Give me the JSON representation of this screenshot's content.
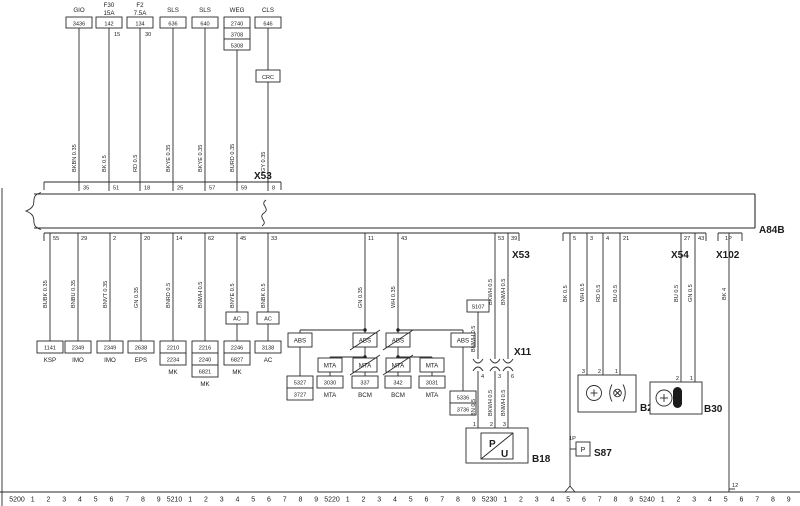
{
  "connectors": {
    "x53_top": "X53",
    "x53_bottom": "X53",
    "x54": "X54",
    "x102": "X102",
    "x11": "X11",
    "bus": "A84B"
  },
  "top_circuits": [
    {
      "name": "GIO",
      "boxes": [
        "3436"
      ],
      "wire": "BKBN 0.35",
      "pin": "35"
    },
    {
      "name": "F30",
      "rating": "15A",
      "boxes": [
        "142"
      ],
      "terminal": "15",
      "wire": "BK 0.5",
      "pin": "51"
    },
    {
      "name": "F2",
      "rating": "7.5A",
      "boxes": [
        "134"
      ],
      "terminal": "30",
      "wire": "RD 0.5",
      "pin": "18"
    },
    {
      "name": "SLS",
      "boxes": [
        "636"
      ],
      "wire": "BKYE 0.35",
      "pin": "25"
    },
    {
      "name": "SLS",
      "boxes": [
        "640"
      ],
      "wire": "BKYE 0.35",
      "pin": "57"
    },
    {
      "name": "WEG",
      "boxes": [
        "2740",
        "3708",
        "5308"
      ],
      "wire": "BURD 0.35",
      "pin": "59"
    },
    {
      "name": "CLS",
      "boxes": [
        "646"
      ],
      "inline_box": "CRC",
      "wire": "GY 0.35",
      "pin": "8"
    }
  ],
  "left_circuits": [
    {
      "pin": "55",
      "wire": "BUBK 0.35",
      "boxes": [
        "1141"
      ],
      "label": "KSP"
    },
    {
      "pin": "29",
      "wire": "BNBU 0.35",
      "boxes": [
        "2349"
      ],
      "label": "IMO"
    },
    {
      "pin": "2",
      "wire": "BNVT 0.35",
      "boxes": [
        "2349"
      ],
      "label": "IMO"
    },
    {
      "pin": "20",
      "wire": "GN 0.35",
      "boxes": [
        "2638"
      ],
      "label": "EPS"
    },
    {
      "pin": "14",
      "wire": "BNRD 0.5",
      "boxes": [
        "2210",
        "2234"
      ],
      "label": "MK"
    },
    {
      "pin": "62",
      "wire": "BNWH 0.5",
      "boxes": [
        "2216",
        "2240",
        "6821"
      ],
      "label": "MK"
    },
    {
      "pin": "45",
      "wire": "BNYE 0.5",
      "inline_box": "AC",
      "boxes": [
        "2246",
        "6827"
      ],
      "label": "MK"
    },
    {
      "pin": "33",
      "wire": "BNBK 0.5",
      "inline_box": "AC",
      "boxes": [
        "3138"
      ],
      "label": "AC"
    }
  ],
  "abs_cluster": {
    "left": {
      "pin": "11",
      "wire": "GN 0.35",
      "pass_box1": "ABS",
      "branch_box1": "ABS",
      "stack": [
        "5327",
        "3727"
      ],
      "pass_box2": "MTA",
      "branch_box2": "MTA",
      "branch_num": "3030",
      "branch_label": "MTA",
      "main_num": "337",
      "main_label": "BCM"
    },
    "right": {
      "pin": "43",
      "wire": "WH 0.35",
      "pass_box1": "ABS",
      "branch_box1": "ABS",
      "stack": [
        "5336",
        "3736"
      ],
      "pass_box2": "MTA",
      "branch_box2": "MTA",
      "branch_num": "3031",
      "branch_label": "MTA",
      "main_num": "342",
      "main_label": "BCM"
    }
  },
  "x11_section": {
    "pins_bus": [
      "53",
      "39"
    ],
    "wires_bus": [
      "BKWH 0.5",
      "BNWH 0.5"
    ],
    "s107": "S107",
    "s107_wire": "BNWH 0.5",
    "label": "X11",
    "pins": [
      "4",
      "3",
      "6"
    ],
    "wires_out": [
      "BN 0.5",
      "BKWH 0.5",
      "BNWH 0.5"
    ],
    "b18_pins": [
      "1",
      "2",
      "3"
    ],
    "b18_p": "P",
    "b18_u": "U",
    "b18": "B18"
  },
  "right_section": {
    "s87": {
      "pin": "5",
      "wire": "BK 0.5",
      "pin_label": "1P",
      "symbol": "P",
      "label": "S87"
    },
    "b28": {
      "pins_bus": [
        "3",
        "4",
        "21"
      ],
      "wires": [
        "WH 0.5",
        "RD 0.5",
        "BU 0.5"
      ],
      "pins": [
        "3",
        "2",
        "1"
      ],
      "label": "B28"
    },
    "b30": {
      "pins_bus": [
        "27",
        "43"
      ],
      "wires": [
        "BU 0.5",
        "GN 0.5"
      ],
      "pins": [
        "2",
        "1"
      ],
      "label": "B30"
    },
    "x102": {
      "pin": "1P",
      "wire": "BK 4",
      "end_ref": "12"
    }
  },
  "ruler": {
    "majors": [
      "5200",
      "5210",
      "5220",
      "5230",
      "5240"
    ],
    "digits": [
      "1",
      "2",
      "3",
      "4",
      "5",
      "6",
      "7",
      "8",
      "9"
    ]
  }
}
